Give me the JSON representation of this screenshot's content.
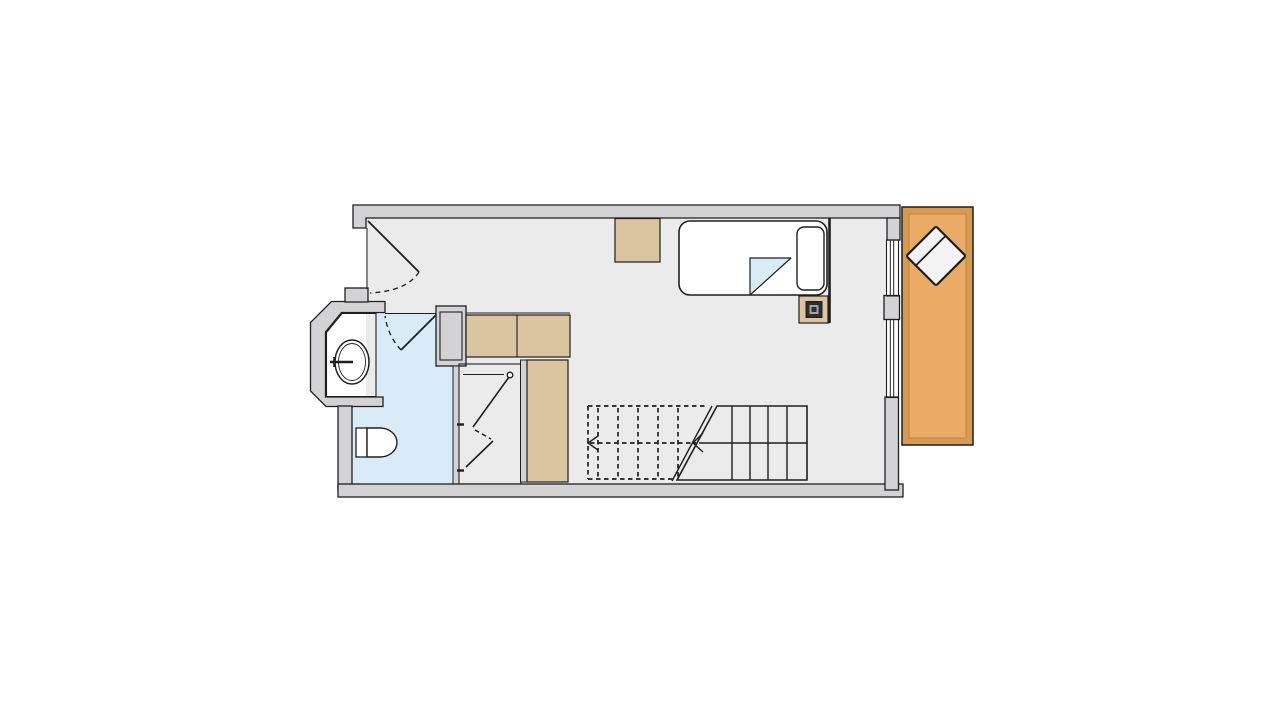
{
  "title": "Studio apartment floor plan",
  "colors": {
    "background": "#ffffff",
    "wall_fill": "#d3d3d5",
    "wall_outline": "#1f1f1f",
    "floor_main": "#ebebec",
    "floor_bathroom": "#d8ebf7",
    "floor_vanity": "#f6f4fb",
    "floor_closet": "#ffffff",
    "wood_furniture": "#dbc5a0",
    "deck_frame": "#d89a52",
    "deck_floor": "#e9ab66",
    "fixture_white": "#ffffff",
    "blanket_blue": "#d8ecf8",
    "chair_white": "#f3f3f3",
    "lamp_dark": "#2e2e2e",
    "lamp_light": "#a5a5a5"
  },
  "plan": {
    "type": "floor-plan",
    "rooms": [
      {
        "name": "main-room",
        "floor": "light-gray"
      },
      {
        "name": "bathroom",
        "floor": "light-blue"
      },
      {
        "name": "vanity-bay",
        "floor": "pale-lavender"
      },
      {
        "name": "closet",
        "floor": "white"
      },
      {
        "name": "wood-deck",
        "floor": "orange-wood"
      }
    ],
    "fixtures": [
      "entrance-door-swing",
      "bathroom-door-swing",
      "folding-closet-door",
      "vanity-sink",
      "faucet",
      "toilet",
      "single-bed",
      "pillow",
      "folded-blanket",
      "nightstand",
      "table-lamp",
      "partition-screen",
      "storage-box",
      "counter-top",
      "wardrobe-column",
      "window",
      "window",
      "deck-chair",
      "staircase"
    ],
    "stairs": {
      "solid_treads": 4,
      "dashed_treads": 5,
      "direction_arrow": "pointing-left",
      "break_line": "double-diagonal"
    },
    "windows_on_right_wall": 2
  }
}
